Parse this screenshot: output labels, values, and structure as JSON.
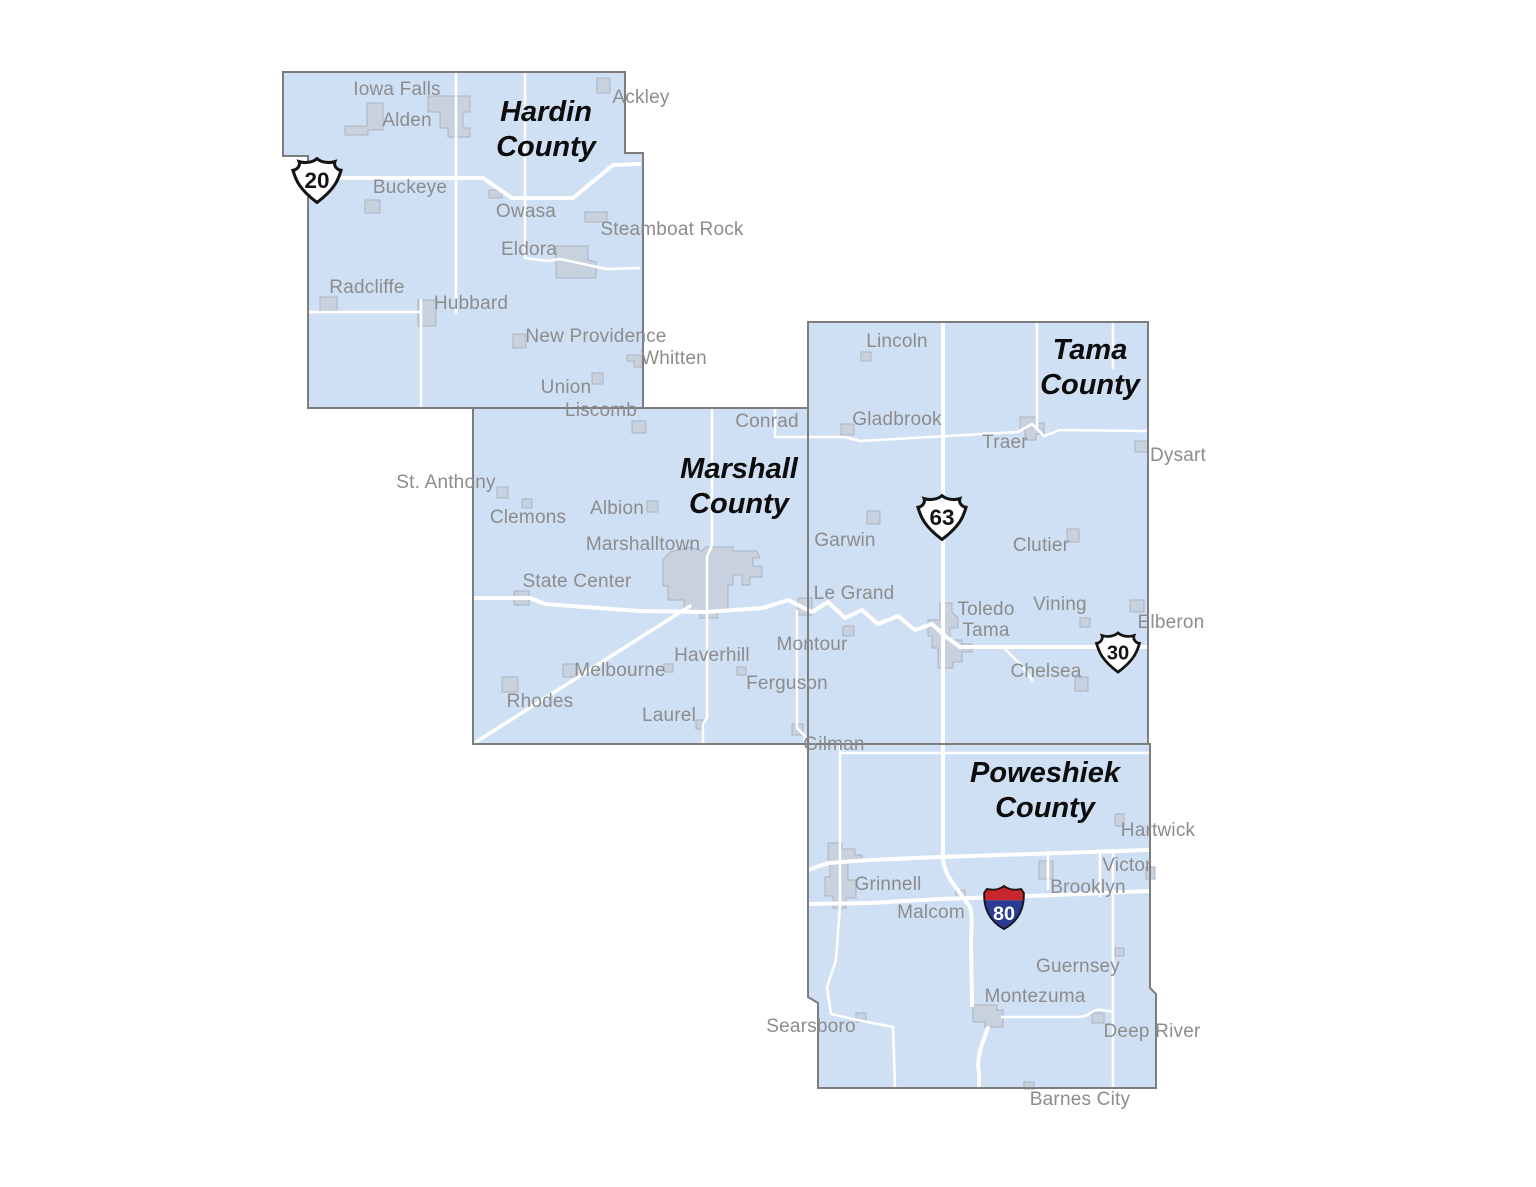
{
  "palette": {
    "background": "#ffffff",
    "county_fill": "#cfe0f4",
    "county_border": "#7d7d7d",
    "road": "#ffffff",
    "town_fill": "#c8d1de",
    "town_border": "#abb4c3",
    "town_label": "#8c8c8c",
    "county_label": "#0c0c0c",
    "shield_fill": "#ffffff",
    "shield_outline": "#141414",
    "interstate_red": "#c8252c",
    "interstate_blue": "#2a3b94",
    "interstate_number": "#ffffff"
  },
  "counties": [
    {
      "name": "Hardin County",
      "lines": [
        "Hardin",
        "County"
      ],
      "x": 546,
      "y": 130
    },
    {
      "name": "Marshall County",
      "lines": [
        "Marshall",
        "County"
      ],
      "x": 739,
      "y": 487
    },
    {
      "name": "Tama County",
      "lines": [
        "Tama",
        "County"
      ],
      "x": 1090,
      "y": 368
    },
    {
      "name": "Poweshiek County",
      "lines": [
        "Poweshiek",
        "County"
      ],
      "x": 1045,
      "y": 791
    }
  ],
  "towns": [
    {
      "name": "Iowa Falls",
      "county": "Hardin",
      "x": 397,
      "y": 90
    },
    {
      "name": "Alden",
      "county": "Hardin",
      "x": 407,
      "y": 121
    },
    {
      "name": "Ackley",
      "county": "Hardin",
      "x": 641,
      "y": 98
    },
    {
      "name": "Buckeye",
      "county": "Hardin",
      "x": 410,
      "y": 188
    },
    {
      "name": "Owasa",
      "county": "Hardin",
      "x": 526,
      "y": 212
    },
    {
      "name": "Steamboat Rock",
      "county": "Hardin",
      "x": 672,
      "y": 230
    },
    {
      "name": "Eldora",
      "county": "Hardin",
      "x": 529,
      "y": 250
    },
    {
      "name": "Radcliffe",
      "county": "Hardin",
      "x": 367,
      "y": 288
    },
    {
      "name": "Hubbard",
      "county": "Hardin",
      "x": 471,
      "y": 304
    },
    {
      "name": "New Providence",
      "county": "Hardin",
      "x": 596,
      "y": 337
    },
    {
      "name": "Whitten",
      "county": "Hardin",
      "x": 674,
      "y": 359
    },
    {
      "name": "Union",
      "county": "Hardin",
      "x": 566,
      "y": 388
    },
    {
      "name": "Liscomb",
      "county": "Marshall",
      "x": 601,
      "y": 411
    },
    {
      "name": "Conrad",
      "county": "Marshall",
      "x": 767,
      "y": 422
    },
    {
      "name": "St. Anthony",
      "county": "Marshall",
      "x": 446,
      "y": 483
    },
    {
      "name": "Clemons",
      "county": "Marshall",
      "x": 528,
      "y": 518
    },
    {
      "name": "Albion",
      "county": "Marshall",
      "x": 617,
      "y": 509
    },
    {
      "name": "Marshalltown",
      "county": "Marshall",
      "x": 643,
      "y": 545
    },
    {
      "name": "State Center",
      "county": "Marshall",
      "x": 577,
      "y": 582
    },
    {
      "name": "Le Grand",
      "county": "Marshall",
      "x": 854,
      "y": 594
    },
    {
      "name": "Montour",
      "county": "Marshall",
      "x": 812,
      "y": 645
    },
    {
      "name": "Haverhill",
      "county": "Marshall",
      "x": 712,
      "y": 656
    },
    {
      "name": "Melbourne",
      "county": "Marshall",
      "x": 620,
      "y": 671
    },
    {
      "name": "Ferguson",
      "county": "Marshall",
      "x": 787,
      "y": 684
    },
    {
      "name": "Rhodes",
      "county": "Marshall",
      "x": 540,
      "y": 702
    },
    {
      "name": "Laurel",
      "county": "Marshall",
      "x": 669,
      "y": 716
    },
    {
      "name": "Gilman",
      "county": "Marshall",
      "x": 834,
      "y": 745
    },
    {
      "name": "Lincoln",
      "county": "Tama",
      "x": 897,
      "y": 342
    },
    {
      "name": "Gladbrook",
      "county": "Tama",
      "x": 897,
      "y": 420
    },
    {
      "name": "Traer",
      "county": "Tama",
      "x": 1005,
      "y": 443
    },
    {
      "name": "Dysart",
      "county": "Tama",
      "x": 1178,
      "y": 456
    },
    {
      "name": "Garwin",
      "county": "Tama",
      "x": 845,
      "y": 541
    },
    {
      "name": "Clutier",
      "county": "Tama",
      "x": 1041,
      "y": 546
    },
    {
      "name": "Vining",
      "county": "Tama",
      "x": 1060,
      "y": 605
    },
    {
      "name": "Toledo",
      "county": "Tama",
      "x": 986,
      "y": 610
    },
    {
      "name": "Tama",
      "county": "Tama",
      "x": 986,
      "y": 631
    },
    {
      "name": "Elberon",
      "county": "Tama",
      "x": 1171,
      "y": 623
    },
    {
      "name": "Chelsea",
      "county": "Tama",
      "x": 1046,
      "y": 672
    },
    {
      "name": "Hartwick",
      "county": "Poweshiek",
      "x": 1158,
      "y": 831
    },
    {
      "name": "Victor",
      "county": "Poweshiek",
      "x": 1127,
      "y": 866
    },
    {
      "name": "Brooklyn",
      "county": "Poweshiek",
      "x": 1088,
      "y": 888
    },
    {
      "name": "Grinnell",
      "county": "Poweshiek",
      "x": 888,
      "y": 885
    },
    {
      "name": "Malcom",
      "county": "Poweshiek",
      "x": 931,
      "y": 913
    },
    {
      "name": "Guernsey",
      "county": "Poweshiek",
      "x": 1078,
      "y": 967
    },
    {
      "name": "Montezuma",
      "county": "Poweshiek",
      "x": 1035,
      "y": 997
    },
    {
      "name": "Searsboro",
      "county": "Poweshiek",
      "x": 811,
      "y": 1027
    },
    {
      "name": "Deep River",
      "county": "Poweshiek",
      "x": 1152,
      "y": 1032
    },
    {
      "name": "Barnes City",
      "county": "Poweshiek",
      "x": 1080,
      "y": 1100
    }
  ],
  "shields": [
    {
      "system": "US",
      "route": "20",
      "x": 317,
      "y": 183,
      "w": 52,
      "h": 47
    },
    {
      "system": "US",
      "route": "63",
      "x": 942,
      "y": 520,
      "w": 52,
      "h": 47
    },
    {
      "system": "US",
      "route": "30",
      "x": 1118,
      "y": 655,
      "w": 46,
      "h": 42
    },
    {
      "system": "Interstate",
      "route": "80",
      "x": 1004,
      "y": 910,
      "w": 45,
      "h": 47
    }
  ]
}
